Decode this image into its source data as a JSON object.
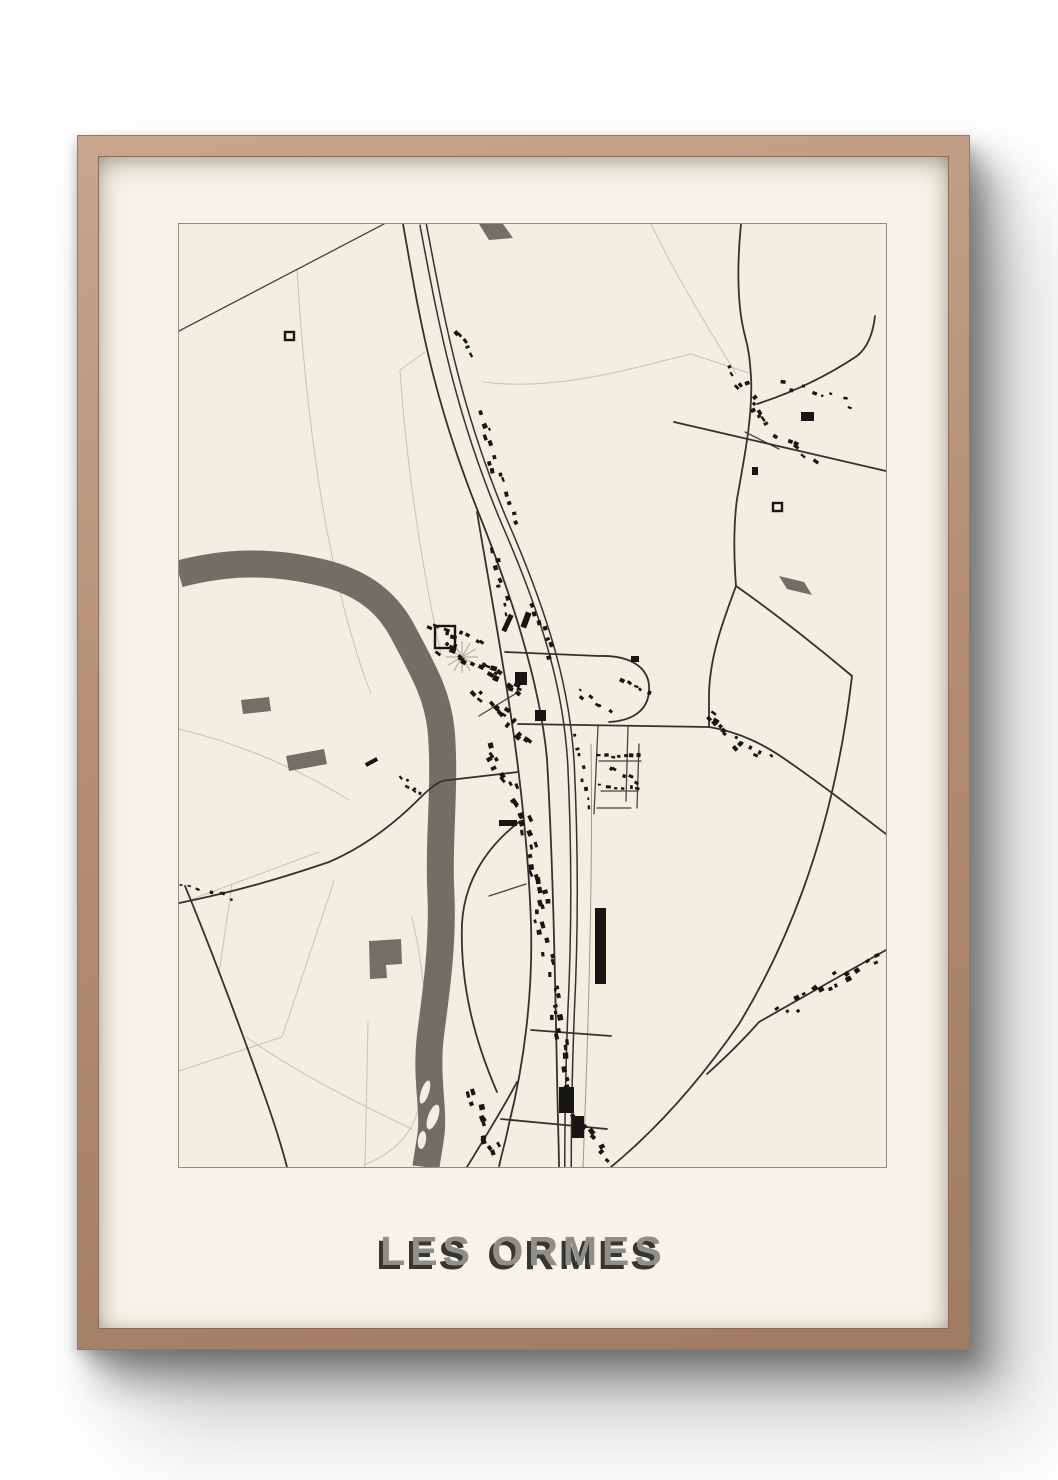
{
  "poster": {
    "title": "LES ORMES",
    "colors": {
      "wall": "#ffffff",
      "frame_wood_light": "#c9a58d",
      "frame_wood": "#b58e75",
      "frame_wood_dark": "#a27b63",
      "frame_edge_dark": "#8a6c57",
      "mat": "#f6f4e9",
      "paper": "#f1eee2",
      "map_border": "#8e8e88",
      "title_fill": "#8f8e8a",
      "title_shadow": "#38372f"
    }
  },
  "map": {
    "width": 707,
    "height": 943,
    "colors": {
      "river": "#706e65",
      "patch": "#716f66",
      "road_main": "#33322e",
      "road_secondary": "#45443e",
      "road_light": "#9a988d",
      "field_line": "#c6c4b6",
      "building": "#171613",
      "island": "#f1eee2",
      "park": "#b3b1a4"
    },
    "field_lines": [
      "M118,46 C128,210 150,360 192,470",
      "M246,128 L221,146 C228,250 246,360 262,430",
      "M304,158 C380,168 460,142 512,130 L570,149",
      "M472,0 C500,58 532,108 557,150",
      "M0,505 C62,520 122,546 170,576",
      "M0,680 L140,628",
      "M155,657 L103,813",
      "M0,847 L103,813",
      "M67,813 C120,850 180,880 233,905",
      "M233,693 C248,760 252,822 240,882 C233,913 212,930 185,941",
      "M53,660 L40,750",
      "M189,798 L186,943"
    ],
    "patches": [
      "M300,0 L324,0 L334,14 L310,16 Z",
      "M600,352 L625,358 L633,371 L608,365 Z",
      "M62,476 L90,473 L92,487 L64,490 Z",
      "M107,532 L145,525 L148,540 L110,547 Z",
      "M190,717 L222,715 L223,740 L207,741 L208,754 L191,755 Z"
    ],
    "river": {
      "d": "M0,350 C45,338 90,336 140,348 C185,358 210,380 225,410 C245,448 258,470 262,505 C267,560 259,615 262,672 C264,725 256,775 251,815 C247,855 255,885 252,910 C250,925 248,934 247,943",
      "width": 27
    },
    "islands": [
      [
        246,
        868,
        4,
        12,
        18
      ],
      [
        254,
        893,
        5,
        13,
        20
      ],
      [
        243,
        916,
        4,
        9,
        8
      ]
    ],
    "roads_secondary": [
      "M205,0 L0,107",
      "M419,502 L415,590",
      "M449,502 L447,577",
      "M460,520 L458,584",
      "M420,537 L462,537",
      "M422,567 L459,567",
      "M418,584 L452,584",
      "M336,470 L300,492",
      "M347,660 L310,672",
      "M566,208 L600,225"
    ],
    "railway": {
      "d": "M244,0 C262,95 278,185 325,297 C370,400 388,470 392,540 C396,625 396,710 392,790 C390,845 389,895 389,943"
    },
    "roads_main": [
      "M224,0 C240,90 252,170 300,290 C340,390 362,470 368,535 C374,640 376,750 378,850 C379,905 380,928 380,943",
      "M298,288 C310,360 325,440 336,520 C344,580 350,640 352,700 C354,770 345,840 330,900 C326,920 322,932 320,943",
      "M338,858 C322,888 305,915 288,943",
      "M0,679 C55,668 100,655 150,638 C185,623 215,600 240,575 C255,560 262,556 270,556 L339,548",
      "M6,662 C30,720 60,800 85,870 C95,898 102,920 108,943",
      "M562,0 C558,40 558,82 566,112 C571,130 571,142 572,152 C574,190 566,230 558,275 C554,305 555,335 557,362",
      "M557,362 C590,385 635,420 673,452 C660,565 628,688 560,800 C520,858 478,905 432,943",
      "M557,362 C545,395 531,430 530,470 L530,503",
      "M339,500 L530,503",
      "M530,503 C560,508 585,520 610,538 C645,562 678,588 707,610",
      "M495,198 L707,247",
      "M578,180 C615,168 648,152 678,132 C688,124 694,110 696,92",
      "M326,428 L420,432 C455,431 472,446 470,468 C468,489 450,497 430,498",
      "M352,806 L432,812",
      "M322,895 L428,905",
      "M528,850 C548,832 565,815 580,798 L707,726",
      "M340,598 C305,625 285,660 283,700 C281,760 295,815 318,868"
    ],
    "roads_light": [
      "M412,520 C414,640 410,790 404,943"
    ],
    "park_star": {
      "cx": 283,
      "cy": 433,
      "r": 16,
      "lines": 6
    },
    "outlines": [
      [
        256,
        402,
        20,
        22
      ],
      [
        106,
        108,
        9,
        8
      ],
      [
        594,
        279,
        9,
        8
      ]
    ],
    "strips": [
      [
        280,
        108,
        292,
        128,
        5,
        3,
        3
      ],
      [
        303,
        192,
        318,
        252,
        9,
        3.5,
        4
      ],
      [
        322,
        258,
        336,
        298,
        5,
        3,
        3
      ],
      [
        252,
        400,
        300,
        418,
        9,
        4,
        5
      ],
      [
        262,
        422,
        348,
        466,
        22,
        4,
        8
      ],
      [
        300,
        468,
        350,
        516,
        16,
        4,
        7
      ],
      [
        310,
        520,
        348,
        598,
        16,
        4,
        6
      ],
      [
        346,
        600,
        366,
        688,
        15,
        4,
        6
      ],
      [
        360,
        690,
        382,
        788,
        14,
        4,
        6
      ],
      [
        376,
        790,
        392,
        858,
        10,
        4,
        5
      ],
      [
        290,
        868,
        318,
        932,
        12,
        4,
        6
      ],
      [
        395,
        895,
        428,
        935,
        8,
        4,
        5
      ],
      [
        398,
        512,
        410,
        585,
        8,
        3,
        3
      ],
      [
        420,
        532,
        460,
        533,
        7,
        3,
        2
      ],
      [
        422,
        562,
        458,
        563,
        6,
        3,
        2
      ],
      [
        430,
        545,
        456,
        556,
        5,
        3,
        3
      ],
      [
        400,
        468,
        428,
        488,
        6,
        3,
        4
      ],
      [
        444,
        455,
        468,
        470,
        5,
        3,
        3
      ],
      [
        530,
        494,
        560,
        520,
        10,
        3.5,
        5
      ],
      [
        563,
        520,
        590,
        535,
        5,
        3,
        4
      ],
      [
        555,
        148,
        588,
        200,
        12,
        3.5,
        6
      ],
      [
        600,
        160,
        672,
        180,
        8,
        3,
        5
      ],
      [
        600,
        214,
        634,
        236,
        6,
        3.5,
        5
      ],
      [
        600,
        790,
        700,
        730,
        16,
        3.5,
        6
      ],
      [
        222,
        556,
        242,
        572,
        6,
        3,
        3
      ],
      [
        5,
        658,
        55,
        672,
        7,
        2.5,
        4
      ],
      [
        314,
        330,
        330,
        388,
        8,
        3.5,
        4
      ],
      [
        355,
        378,
        372,
        430,
        7,
        3.5,
        4
      ]
    ],
    "singles": [
      [
        326,
        390,
        5,
        18,
        25
      ],
      [
        344,
        388,
        6,
        16,
        20
      ],
      [
        336,
        448,
        12,
        13,
        0
      ],
      [
        356,
        486,
        11,
        11,
        0
      ],
      [
        320,
        596,
        18,
        6,
        0
      ],
      [
        416,
        684,
        11,
        76,
        0
      ],
      [
        380,
        863,
        15,
        26,
        0
      ],
      [
        393,
        892,
        12,
        22,
        0
      ],
      [
        186,
        536,
        13,
        4,
        -28
      ],
      [
        622,
        188,
        13,
        9,
        0
      ],
      [
        452,
        432,
        8,
        6,
        0
      ],
      [
        573,
        243,
        6,
        8,
        0
      ]
    ]
  }
}
